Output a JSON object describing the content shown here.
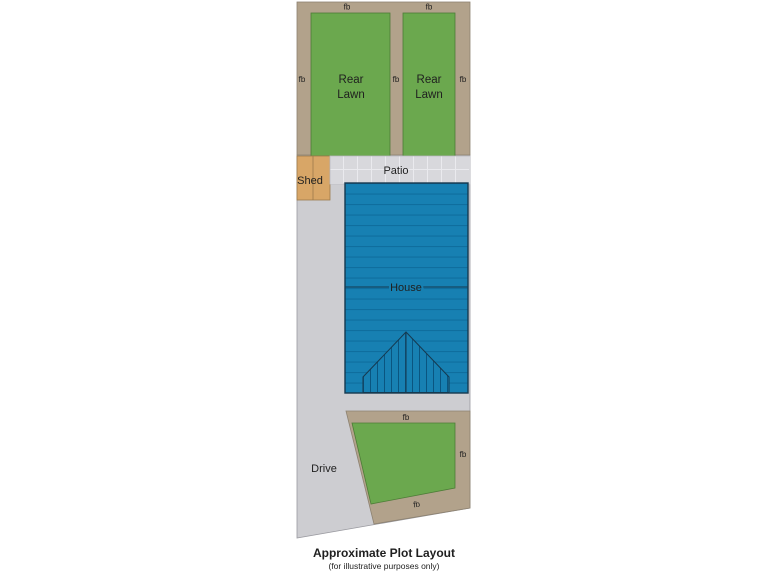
{
  "diagram": {
    "caption": {
      "title": "Approximate Plot Layout",
      "subtitle": "(for illustrative purposes only)"
    },
    "regions": {
      "rear_lawn": {
        "line1": "Rear",
        "line2": "Lawn"
      },
      "shed": "Shed",
      "patio": "Patio",
      "house": "House",
      "drive": "Drive",
      "flower_bed_abbrev": "fb"
    },
    "colors": {
      "lawn-green": "#6ba84e",
      "bed-tan": "#b2a28b",
      "shed-orange": "#d8a667",
      "patio-grey": "#d8d8dc",
      "drive-grey": "#cdcdd1",
      "house-blue": "#1780b2",
      "house-stripe": "#0f6e9e",
      "house-outline": "#16394f",
      "text": "#1f1f1f"
    }
  }
}
